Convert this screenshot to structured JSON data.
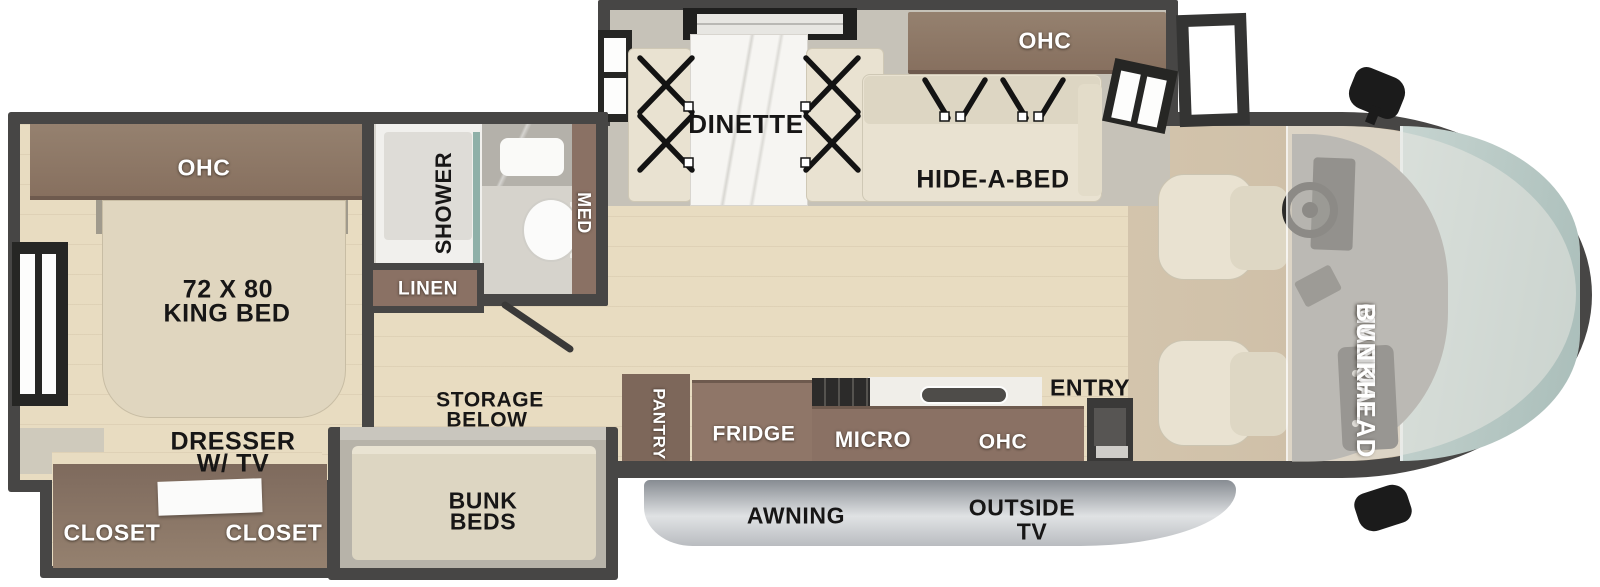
{
  "plan_labels": {
    "bedroom": {
      "ohc": "OHC",
      "bed_size": "72 X 80",
      "bed_type": "KING BED",
      "dresser_line1": "DRESSER",
      "dresser_line2": "W/ TV",
      "closet_left": "CLOSET",
      "closet_right": "CLOSET"
    },
    "bathroom": {
      "shower": "SHOWER",
      "med": "MED",
      "linen": "LINEN"
    },
    "living": {
      "dinette": "DINETTE",
      "ohc": "OHC",
      "hide_a_bed": "HIDE-A-BED"
    },
    "kitchen": {
      "pantry": "PANTRY",
      "fridge": "FRIDGE",
      "micro": "MICRO",
      "ohc": "OHC",
      "entry": "ENTRY"
    },
    "bunk": {
      "storage_line1": "STORAGE",
      "storage_line2": "BELOW",
      "line1": "BUNK",
      "line2": "BEDS"
    },
    "exterior": {
      "awning": "AWNING",
      "outside_tv_line1": "OUTSIDE",
      "outside_tv_line2": "TV"
    },
    "cab": {
      "overhead_bunk_line1": "MANUAL",
      "overhead_bunk_line2": "OVERHEAD",
      "overhead_bunk_line3": "BUNK"
    }
  },
  "colors": {
    "wall": "#474645",
    "floor_wood": "#e8dcc1",
    "slideout_floor": "#c6c2b8",
    "cabinet_brown": "#8a7164",
    "cabinet_dark_brown": "#7d675a",
    "furniture_cream": "#e9e2d1",
    "windshield_glass": "#b9c9c5",
    "awning_silver": "#cdd0d3",
    "label_dark": "#171616",
    "label_light": "#ffffff"
  }
}
